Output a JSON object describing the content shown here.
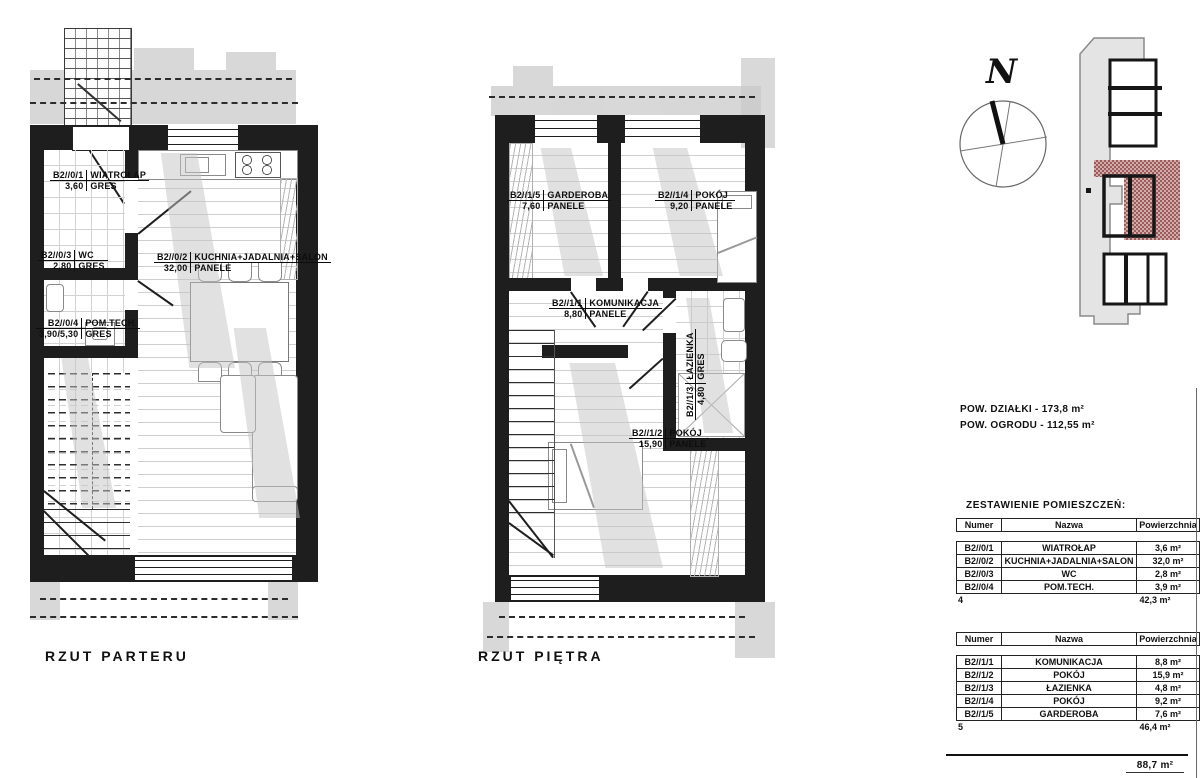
{
  "plans": [
    {
      "title": "RZUT PARTERU"
    },
    {
      "title": "RZUT PIĘTRA"
    }
  ],
  "ground_rooms": [
    {
      "id": "B2//0/1",
      "name": "WIATROŁAP",
      "area": "3,60",
      "floor": "GRES"
    },
    {
      "id": "B2//0/3",
      "name": "WC",
      "area": "2,80",
      "floor": "GRES"
    },
    {
      "id": "B2//0/2",
      "name": "KUCHNIA+JADALNIA+SALON",
      "area": "32,00",
      "floor": "PANELE"
    },
    {
      "id": "B2//0/4",
      "name": "POM.TECH.",
      "area": "3,90/5,30",
      "floor": "GRES"
    }
  ],
  "first_rooms": [
    {
      "id": "B2//1/5",
      "name": "GARDEROBA",
      "area": "7,60",
      "floor": "PANELE"
    },
    {
      "id": "B2//1/4",
      "name": "POKÓJ",
      "area": "9,20",
      "floor": "PANELE"
    },
    {
      "id": "B2//1/1",
      "name": "KOMUNIKACJA",
      "area": "8,80",
      "floor": "PANELE"
    },
    {
      "id": "B2//1/3",
      "name": "ŁAZIENKA",
      "area": "4,80",
      "floor": "GRES"
    },
    {
      "id": "B2//1/2",
      "name": "POKÓJ",
      "area": "15,90",
      "floor": "PANELE"
    }
  ],
  "compass": {
    "north": "N"
  },
  "site_info": {
    "plot_area": "POW. DZIAŁKI - 173,8 m²",
    "garden_area": "POW. OGRODU - 112,55 m²"
  },
  "schedule": {
    "heading": "ZESTAWIENIE POMIESZCZEŃ:",
    "columns": [
      "Numer",
      "Nazwa",
      "Powierzchnia"
    ],
    "ground": {
      "rows": [
        {
          "num": "B2//0/1",
          "name": "WIATROŁAP",
          "area": "3,6 m²"
        },
        {
          "num": "B2//0/2",
          "name": "KUCHNIA+JADALNIA+SALON",
          "area": "32,0 m²"
        },
        {
          "num": "B2//0/3",
          "name": "WC",
          "area": "2,8 m²"
        },
        {
          "num": "B2//0/4",
          "name": "POM.TECH.",
          "area": "3,9 m²"
        }
      ],
      "count": "4",
      "subtotal": "42,3 m²"
    },
    "first": {
      "rows": [
        {
          "num": "B2//1/1",
          "name": "KOMUNIKACJA",
          "area": "8,8 m²"
        },
        {
          "num": "B2//1/2",
          "name": "POKÓJ",
          "area": "15,9 m²"
        },
        {
          "num": "B2//1/3",
          "name": "ŁAZIENKA",
          "area": "4,8 m²"
        },
        {
          "num": "B2//1/4",
          "name": "POKÓJ",
          "area": "9,2 m²"
        },
        {
          "num": "B2//1/5",
          "name": "GARDEROBA",
          "area": "7,6 m²"
        }
      ],
      "count": "5",
      "subtotal": "46,4 m²"
    },
    "total": "88,7 m²"
  },
  "colors": {
    "wall": "#1e1e1e",
    "shadow": "#c9c9c9",
    "highlight_hatch": "#9b5c5c"
  }
}
